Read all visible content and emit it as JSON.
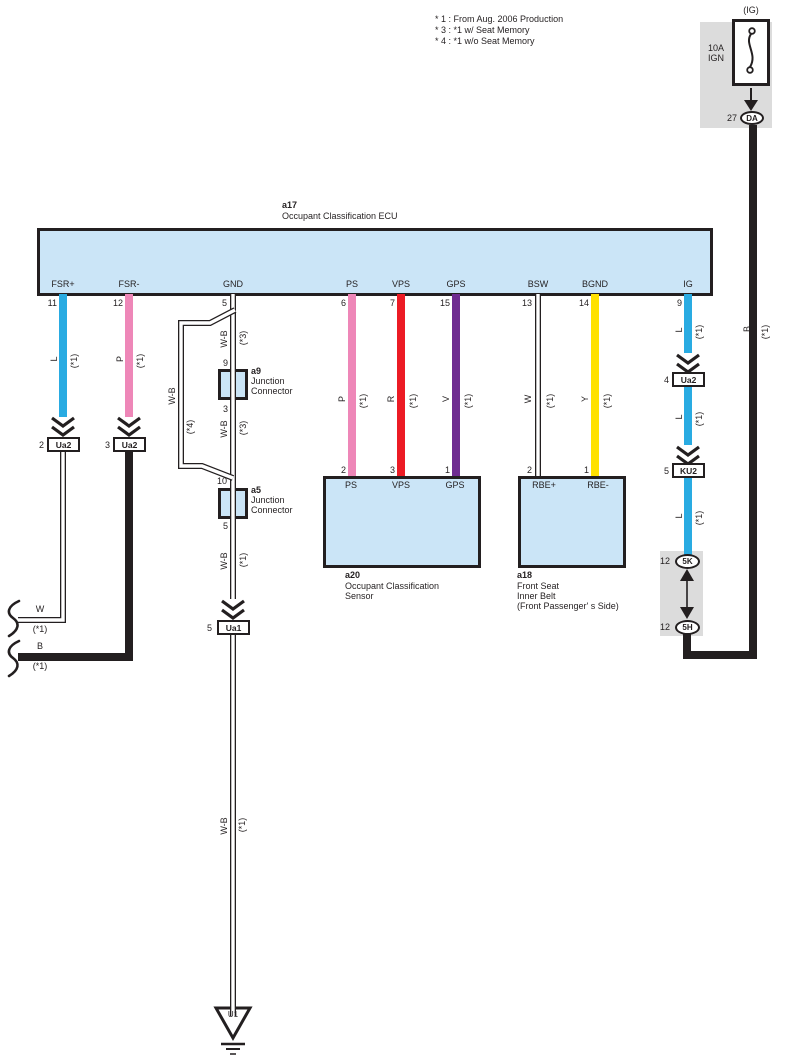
{
  "colors": {
    "wire_blue": "#29ABE2",
    "wire_pink": "#EE87B8",
    "wire_red": "#EC1B24",
    "wire_violet": "#6F2C91",
    "wire_yellow": "#FFE100",
    "wire_black": "#231F20",
    "component_fill": "#CBE5F7",
    "panel_gray": "#DCDCDC"
  },
  "notes": {
    "line1": "* 1 : From Aug. 2006 Production",
    "line2": "* 3 : *1 w/ Seat Memory",
    "line3": "* 4 : *1 w/o Seat Memory"
  },
  "power": {
    "circuit": "(IG)",
    "fuse_rating": "10A",
    "fuse_name": "IGN",
    "pin": "27",
    "connector": "DA"
  },
  "ecu": {
    "id": "a17",
    "name": "Occupant Classification ECU",
    "pins": [
      {
        "num": "11",
        "name": "FSR+"
      },
      {
        "num": "12",
        "name": "FSR-"
      },
      {
        "num": "5",
        "name": "GND"
      },
      {
        "num": "6",
        "name": "PS"
      },
      {
        "num": "7",
        "name": "VPS"
      },
      {
        "num": "15",
        "name": "GPS"
      },
      {
        "num": "13",
        "name": "BSW"
      },
      {
        "num": "14",
        "name": "BGND"
      },
      {
        "num": "9",
        "name": "IG"
      }
    ]
  },
  "junctions": {
    "a9": {
      "id": "a9",
      "line1": "Junction",
      "line2": "Connector",
      "pin_top": "9",
      "pin_bottom": "3"
    },
    "a5": {
      "id": "a5",
      "line1": "Junction",
      "line2": "Connector",
      "pin_top": "10",
      "pin_bottom": "5"
    }
  },
  "components": {
    "a20": {
      "id": "a20",
      "name1": "Occupant Classification",
      "name2": "Sensor",
      "pins": [
        {
          "num": "2",
          "name": "PS"
        },
        {
          "num": "3",
          "name": "VPS"
        },
        {
          "num": "1",
          "name": "GPS"
        }
      ]
    },
    "a18": {
      "id": "a18",
      "name1": "Front Seat",
      "name2": "Inner Belt",
      "name3": "(Front Passenger' s Side)",
      "pins": [
        {
          "num": "2",
          "name": "RBE+"
        },
        {
          "num": "1",
          "name": "RBE-"
        }
      ]
    }
  },
  "connectors": {
    "ua2_2": {
      "pin": "2",
      "name": "Ua2"
    },
    "ua2_3": {
      "pin": "3",
      "name": "Ua2"
    },
    "ua2_4": {
      "pin": "4",
      "name": "Ua2"
    },
    "ku2": {
      "pin": "5",
      "name": "KU2"
    },
    "ua1": {
      "pin": "5",
      "name": "Ua1"
    },
    "c5k": {
      "pin": "12",
      "name": "5K"
    },
    "c5h": {
      "pin": "12",
      "name": "5H"
    }
  },
  "wire_labels": {
    "fsr_plus": {
      "c": "L",
      "n": "(*1)"
    },
    "fsr_minus": {
      "c": "P",
      "n": "(*1)"
    },
    "gnd_1": {
      "c": "W-B",
      "n": "(*3)"
    },
    "gnd_2": {
      "c": "W-B",
      "n": "(*3)"
    },
    "gnd_bypass": {
      "c": "W-B",
      "n": "(*4)"
    },
    "gnd_3": {
      "c": "W-B",
      "n": "(*1)"
    },
    "gnd_4": {
      "c": "W-B",
      "n": "(*1)"
    },
    "ps": {
      "c": "P",
      "n": "(*1)"
    },
    "vps": {
      "c": "R",
      "n": "(*1)"
    },
    "gps": {
      "c": "V",
      "n": "(*1)"
    },
    "bsw": {
      "c": "W",
      "n": "(*1)"
    },
    "bgnd": {
      "c": "Y",
      "n": "(*1)"
    },
    "ig_1": {
      "c": "L",
      "n": "(*1)"
    },
    "ig_2": {
      "c": "L",
      "n": "(*1)"
    },
    "ig_3": {
      "c": "L",
      "n": "(*1)"
    },
    "b_right": {
      "c": "B",
      "n": "(*1)"
    },
    "w_cont": {
      "c": "W",
      "n": "(*1)"
    },
    "b_cont": {
      "c": "B",
      "n": "(*1)"
    }
  },
  "ground": {
    "id": "U1"
  }
}
